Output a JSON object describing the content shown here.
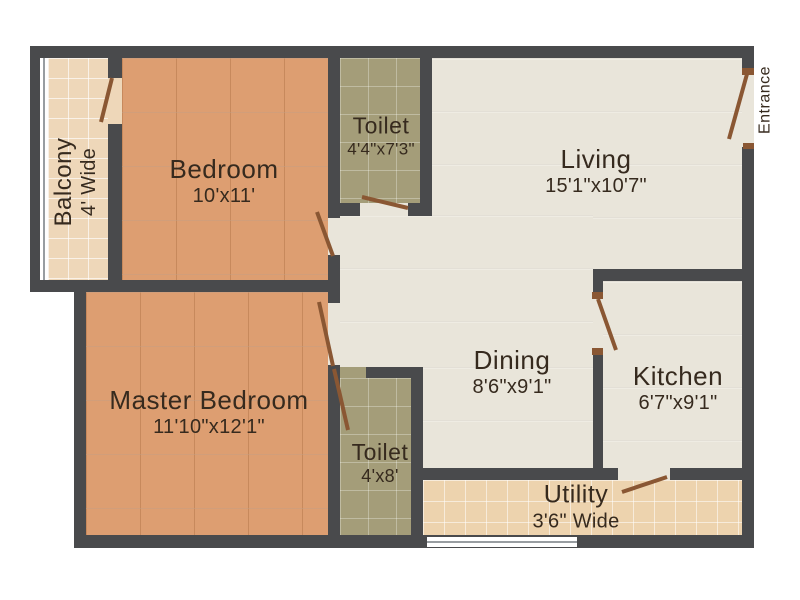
{
  "colors": {
    "wall": "#494a4c",
    "floor_bedroom": "#dd9e71",
    "floor_balcony": "#eed7b9",
    "floor_toilet": "#a49d79",
    "floor_living": "#e9e5da",
    "floor_utility": "#edd3ae",
    "door": "#8a5733",
    "label": "#362a1e"
  },
  "rooms": {
    "balcony": {
      "name": "Balcony",
      "dims": "4' Wide"
    },
    "bedroom": {
      "name": "Bedroom",
      "dims": "10'x11'"
    },
    "toilet_top": {
      "name": "Toilet",
      "dims": "4'4\"x7'3\""
    },
    "living": {
      "name": "Living",
      "dims": "15'1\"x10'7\""
    },
    "master_bedroom": {
      "name": "Master Bedroom",
      "dims": "11'10\"x12'1\""
    },
    "toilet_bottom": {
      "name": "Toilet",
      "dims": "4'x8'"
    },
    "dining": {
      "name": "Dining",
      "dims": "8'6\"x9'1\""
    },
    "kitchen": {
      "name": "Kitchen",
      "dims": "6'7\"x9'1\""
    },
    "utility": {
      "name": "Utility",
      "dims": "3'6\" Wide"
    }
  },
  "labels": {
    "entrance": "Entrance"
  }
}
